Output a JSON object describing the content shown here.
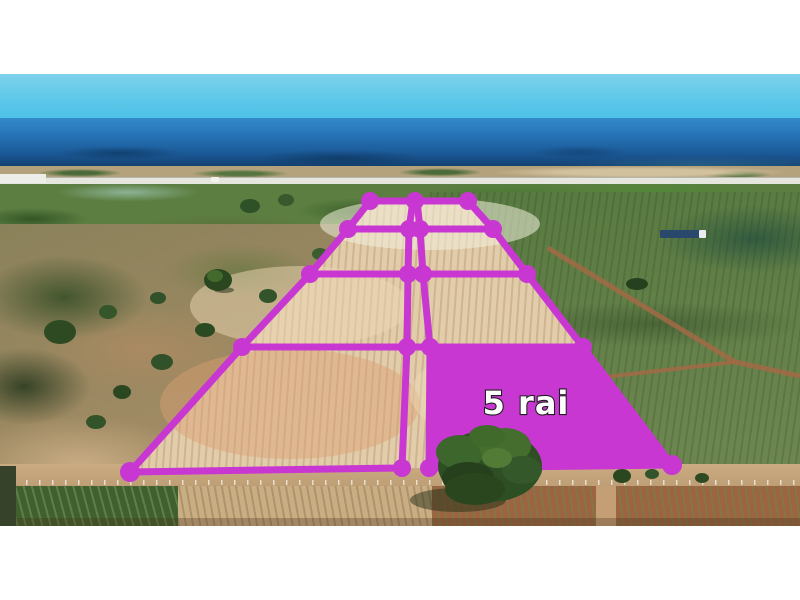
{
  "scene": {
    "description": "Aerial drone photo of subdivided beachfront farmland plots by the sea, letterboxed with white bands",
    "letterbox_top_px": 74,
    "letterbox_bottom_px": 74
  },
  "overlay": {
    "label": "5 rai",
    "highlighted_plot": "bottom-right plot of grid",
    "grid_columns": 2,
    "grid_rows": 4,
    "total_plots": 8
  },
  "colors": {
    "overlay": "#c837d2",
    "label-fill": "#ffffff",
    "label-stroke": "#1f1f1f",
    "sky-top": "#7ed2ec",
    "sky-horizon": "#4dc1e8",
    "sea-top": "#3389ca",
    "sea-deep": "#123d6b",
    "cleared-land": "#e2cdab",
    "green-field": "#66824b",
    "dirt-road": "#c3a47c"
  }
}
